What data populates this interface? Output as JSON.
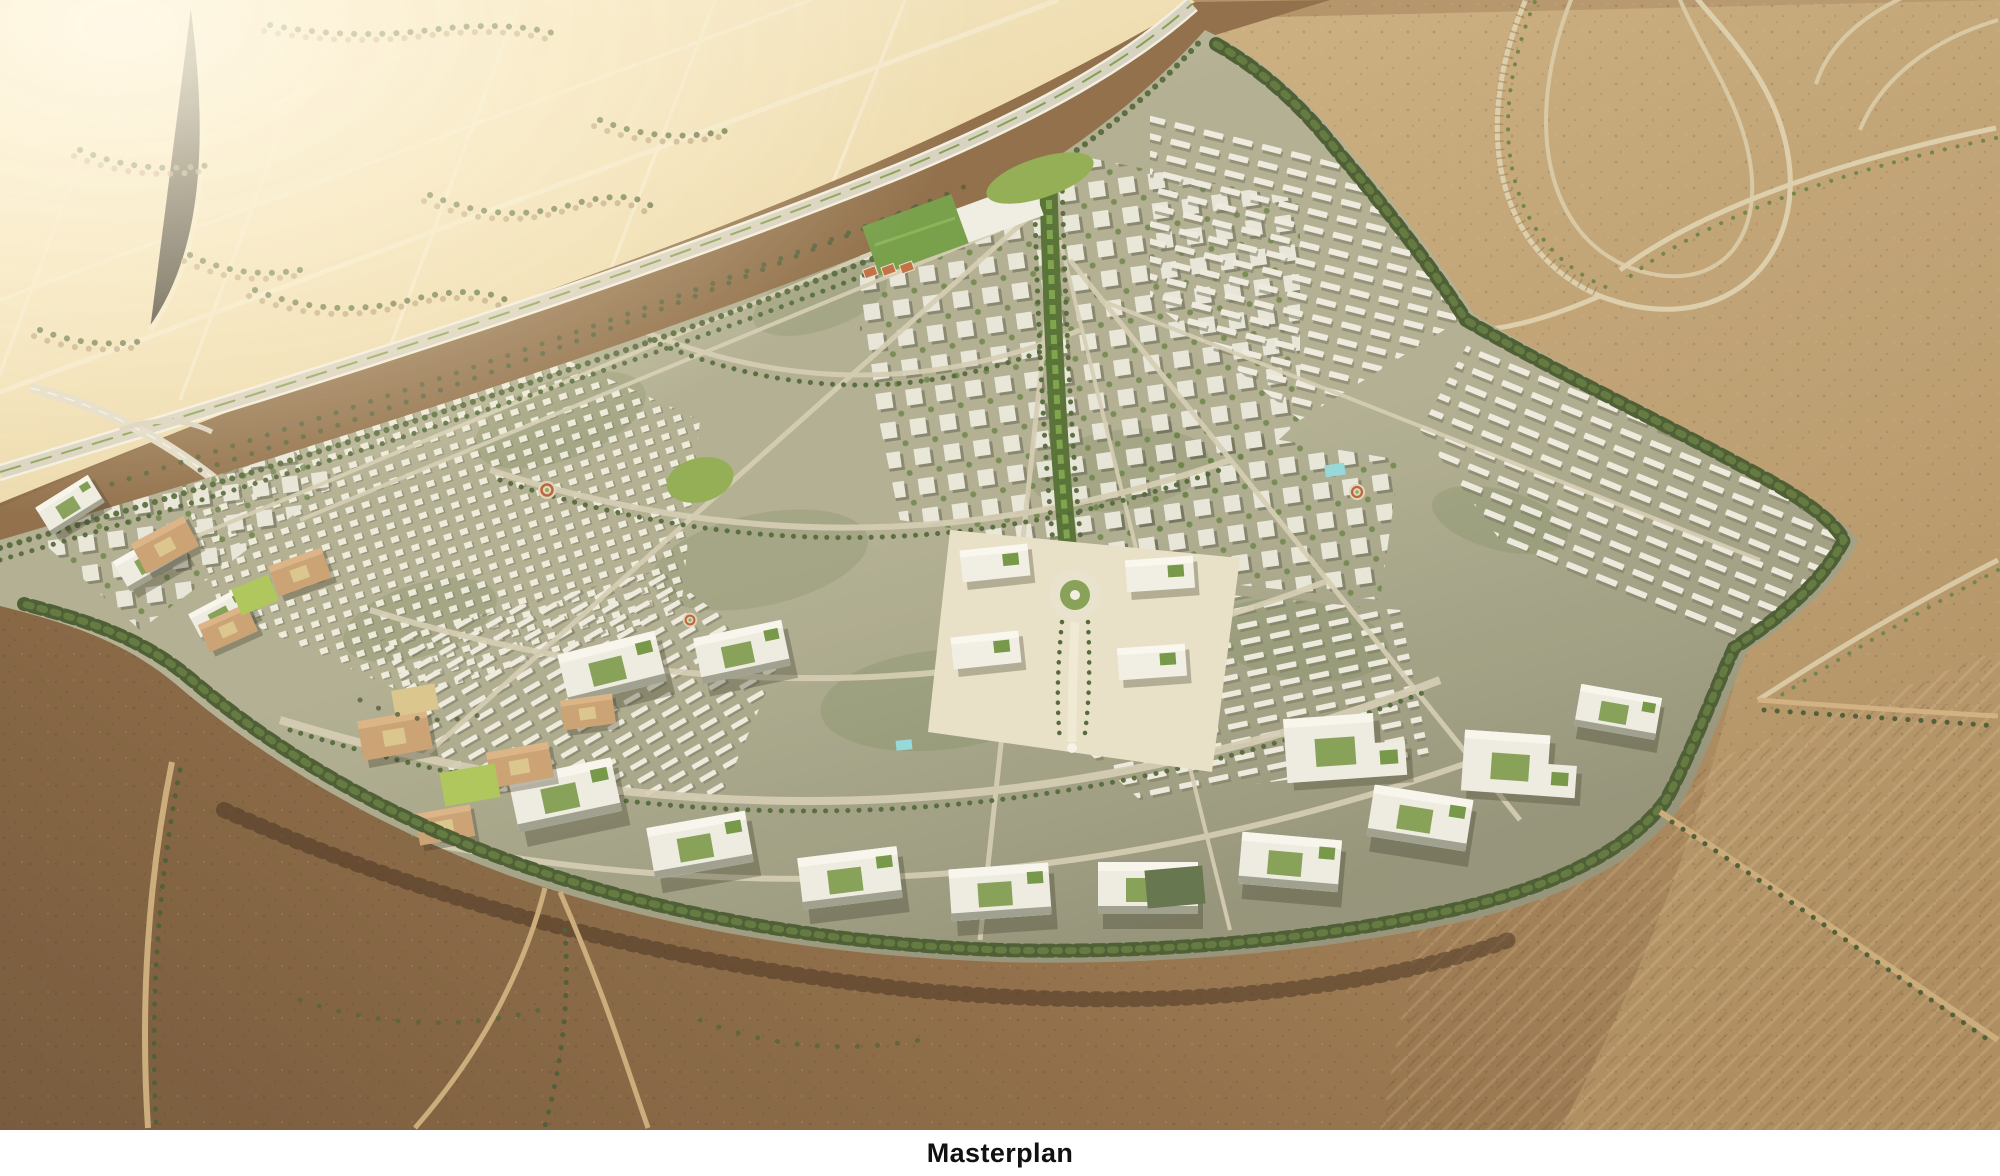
{
  "figure": {
    "caption": "Masterplan"
  },
  "palette": {
    "caption_bg": "#ffffff",
    "caption_text": "#111111",
    "sand_light": "#ecd8a8",
    "sand_bright": "#f7edd2",
    "desert_band": "#8a6843",
    "desert_right_top": "#c8ab7c",
    "desert_right_bottom": "#ac8a5d",
    "desert_deep": "#6f5134",
    "desert_warm": "#b4946a",
    "highway_grey": "#d6d0c0",
    "median_green": "#7c9a4c",
    "city_base": "#aeac90",
    "street_light": "#d2cbb2",
    "spine_green": "#4e6b2f",
    "belt_green": "#42552c",
    "tree_olive": "#5a6b3c",
    "building_white": "#efeee5",
    "roof_green": "#6d9340",
    "civic_paving": "#e7dfc8",
    "campus_tan": "#c79e6f",
    "lawn_green": "#8cab4e",
    "lawn_bright": "#aac455",
    "court_orange": "#c06a3e",
    "pool_cyan": "#8fd8da"
  }
}
